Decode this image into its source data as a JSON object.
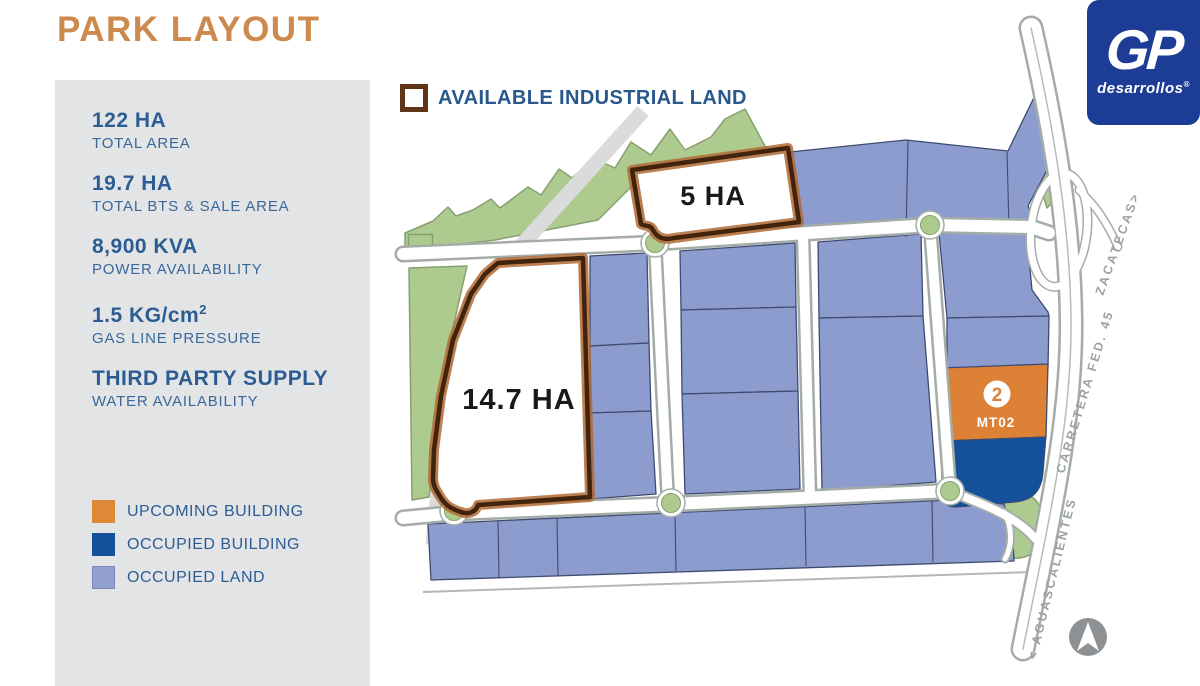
{
  "title": "PARK LAYOUT",
  "sidebar": {
    "stats": [
      {
        "value": "122 HA",
        "label": "TOTAL AREA"
      },
      {
        "value": "19.7 HA",
        "label": "TOTAL BTS & SALE AREA"
      },
      {
        "value": "8,900 KVA",
        "label": "POWER AVAILABILITY"
      },
      {
        "value": "1.5 KG/cm",
        "value_sup": "2",
        "label": "GAS LINE PRESSURE"
      },
      {
        "value": "THIRD PARTY SUPPLY",
        "label": "WATER AVAILABILITY"
      }
    ],
    "legend": [
      {
        "label": "UPCOMING BUILDING",
        "color": "#DF8936"
      },
      {
        "label": "OCCUPIED BUILDING",
        "color": "#15509B"
      },
      {
        "label": "OCCUPIED LAND",
        "color": "#92A1CE"
      }
    ]
  },
  "map": {
    "header": "AVAILABLE INDUSTRIAL LAND",
    "available_plots": [
      {
        "label": "5 HA"
      },
      {
        "label": "14.7 HA"
      }
    ],
    "upcoming_building": {
      "number": "2",
      "code": "MT02"
    },
    "road_labels": {
      "north": "ZACATECAS>",
      "highway": "CARRETERA FED. 45",
      "south": "< AGUASCALIENTES"
    }
  },
  "logo": {
    "brand": "GP",
    "subtitle": "desarrollos",
    "registered": "®"
  },
  "colors": {
    "title_orange": "#CD8A4F",
    "text_blue": "#2C5D92",
    "available_border_brown": "#5F3417",
    "upcoming_orange": "#DC8136",
    "occupied_building_blue": "#15509B",
    "occupied_land_purple": "#8D9CCE",
    "green": "#AECB8F",
    "logo_blue": "#1C3C96"
  }
}
